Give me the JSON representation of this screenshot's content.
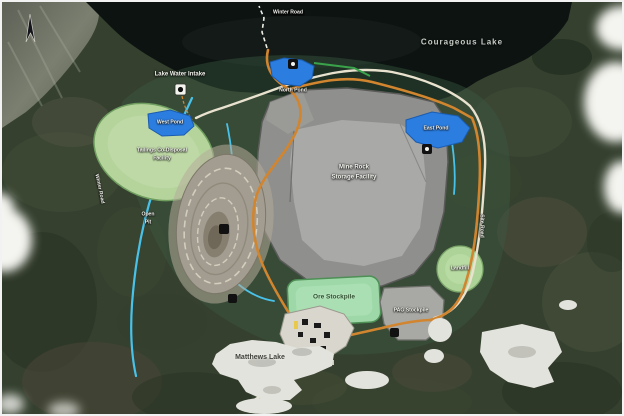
{
  "map": {
    "region_labels": {
      "courageous_lake": "Courageous Lake",
      "matthews_lake": "Matthews Lake"
    },
    "site_labels": {
      "winter_road_top": "Winter Road",
      "lake_water_intake": "Lake Water Intake",
      "north_pond": "North Pond",
      "west_pond": "West Pond",
      "east_pond": "East Pond",
      "tailings_line1": "Tailings Co-Disposal",
      "tailings_line2": "Facility",
      "rsf_line1": "Mine Rock",
      "rsf_line2": "Storage Facility",
      "open_pit_line1": "Open",
      "open_pit_line2": "Pit",
      "ore_stockpile": "Ore Stockpile",
      "pag_stockpile": "PAG Stockpile",
      "landfill": "Landfill",
      "site_road_right": "Site Road",
      "winter_road_left": "Winter Road"
    },
    "colors": {
      "water_dark": "#0c1311",
      "pond_blue": "#2b7de0",
      "haul_road_orange": "#d2852f",
      "stream_cyan": "#49c2ea",
      "access_road_cream": "#e9e2cf",
      "rock_storage_gray": "#959593",
      "reclaim_green": "#b5d49c",
      "stockpile_green": "#9ed8a8",
      "frozen_lake_white": "#e3e3dd"
    }
  }
}
